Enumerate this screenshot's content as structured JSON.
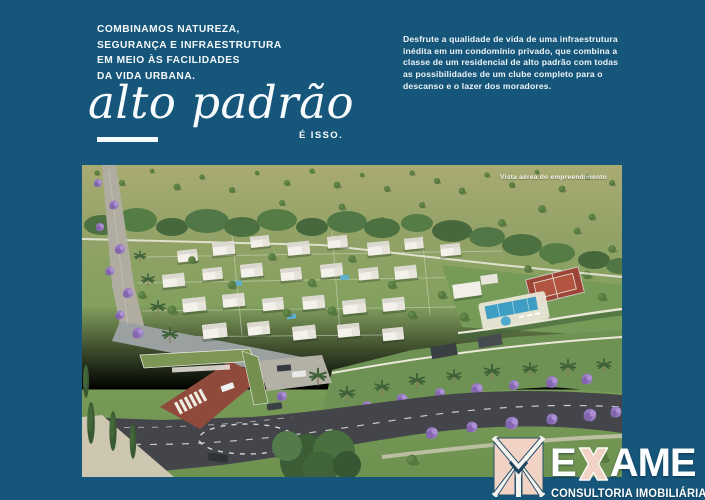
{
  "colors": {
    "background": "#16567A",
    "text": "#FFFFFF",
    "emblem_salmon": "#F1D3C6"
  },
  "intro": {
    "lines": [
      "COMBINAMOS NATUREZA,",
      "SEGURANÇA E INFRAESTRUTURA",
      "EM MEIO ÀS FACILIDADES",
      "DA VIDA URBANA."
    ]
  },
  "headline": {
    "text": "alto padrão",
    "tagline": "É ISSO."
  },
  "description": {
    "text": "Desfrute a qualidade de vida de uma infraestrutura inédita em um condomínio privado, que combina a classe de um residencial de alto padrão com todas as possibilidades de um clube completo para o descanso e o lazer dos moradores."
  },
  "photo": {
    "caption": "Vista aérea do empreendimento"
  },
  "logo": {
    "brand_full": "EXAME",
    "brand_initial": "E",
    "brand_rest": "AME",
    "subtitle": "CONSULTORIA IMOBILIÁRIA"
  }
}
